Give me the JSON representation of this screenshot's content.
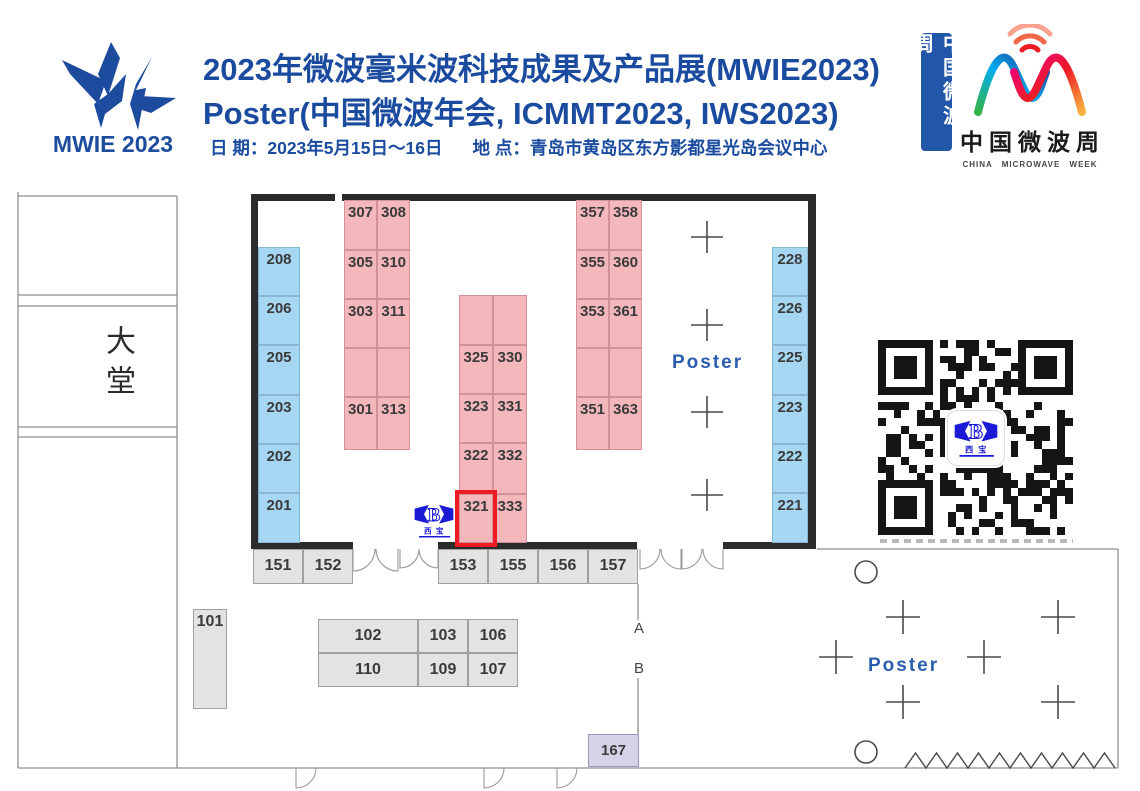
{
  "header": {
    "logo_text": "MWIE 2023",
    "title": "2023年微波毫米波科技成果及产品展(MWIE2023)",
    "subtitle": "Poster(中国微波年会, ICMMT2023, IWS2023)",
    "date_label": "日 期：2023年5月15日～16日",
    "venue_label": "地 点：青岛市黄岛区东方影都星光岛会议中心",
    "badge_vertical": "中国微波周",
    "cmw": {
      "cn": "中国微波周",
      "en": "CHINA MICROWAVE WEEK"
    },
    "brand_blue": "#1b4b9f"
  },
  "floorplan": {
    "lobby_label": "大堂",
    "hall_poster_label": "Poster",
    "outdoor_poster_label": "Poster",
    "entrance_a": "A",
    "entrance_b": "B",
    "highlighted_booth": "321",
    "highlight_color": "#ed1c24",
    "vendor_logo": {
      "letter": "B",
      "name": "西宝",
      "color": "#1b1bd6"
    },
    "booth_colors": {
      "blue": "#a5d6f2",
      "pink": "#f4b7bb",
      "gray": "#e3e3e3",
      "purple": "#d6d2e8"
    },
    "booths": [
      {
        "label": "208",
        "x": 258,
        "y": 247,
        "w": 42,
        "h": 49,
        "t": "blue"
      },
      {
        "label": "206",
        "x": 258,
        "y": 296,
        "w": 42,
        "h": 49,
        "t": "blue"
      },
      {
        "label": "205",
        "x": 258,
        "y": 345,
        "w": 42,
        "h": 50,
        "t": "blue"
      },
      {
        "label": "203",
        "x": 258,
        "y": 395,
        "w": 42,
        "h": 49,
        "t": "blue"
      },
      {
        "label": "202",
        "x": 258,
        "y": 444,
        "w": 42,
        "h": 49,
        "t": "blue"
      },
      {
        "label": "201",
        "x": 258,
        "y": 493,
        "w": 42,
        "h": 50,
        "t": "blue"
      },
      {
        "label": "228",
        "x": 772,
        "y": 247,
        "w": 36,
        "h": 49,
        "t": "blue"
      },
      {
        "label": "226",
        "x": 772,
        "y": 296,
        "w": 36,
        "h": 49,
        "t": "blue"
      },
      {
        "label": "225",
        "x": 772,
        "y": 345,
        "w": 36,
        "h": 50,
        "t": "blue"
      },
      {
        "label": "223",
        "x": 772,
        "y": 395,
        "w": 36,
        "h": 49,
        "t": "blue"
      },
      {
        "label": "222",
        "x": 772,
        "y": 444,
        "w": 36,
        "h": 49,
        "t": "blue"
      },
      {
        "label": "221",
        "x": 772,
        "y": 493,
        "w": 36,
        "h": 50,
        "t": "blue"
      },
      {
        "label": "307",
        "x": 344,
        "y": 200,
        "w": 33,
        "h": 50,
        "t": "pink"
      },
      {
        "label": "308",
        "x": 377,
        "y": 200,
        "w": 33,
        "h": 50,
        "t": "pink"
      },
      {
        "label": "305",
        "x": 344,
        "y": 250,
        "w": 33,
        "h": 49,
        "t": "pink"
      },
      {
        "label": "310",
        "x": 377,
        "y": 250,
        "w": 33,
        "h": 49,
        "t": "pink"
      },
      {
        "label": "303",
        "x": 344,
        "y": 299,
        "w": 33,
        "h": 49,
        "t": "pink"
      },
      {
        "label": "311",
        "x": 377,
        "y": 299,
        "w": 33,
        "h": 49,
        "t": "pink"
      },
      {
        "label": "",
        "x": 344,
        "y": 348,
        "w": 33,
        "h": 49,
        "t": "pink"
      },
      {
        "label": "",
        "x": 377,
        "y": 348,
        "w": 33,
        "h": 49,
        "t": "pink"
      },
      {
        "label": "301",
        "x": 344,
        "y": 397,
        "w": 33,
        "h": 53,
        "t": "pink"
      },
      {
        "label": "313",
        "x": 377,
        "y": 397,
        "w": 33,
        "h": 53,
        "t": "pink"
      },
      {
        "label": "",
        "x": 459,
        "y": 295,
        "w": 34,
        "h": 50,
        "t": "pink"
      },
      {
        "label": "",
        "x": 493,
        "y": 295,
        "w": 34,
        "h": 50,
        "t": "pink"
      },
      {
        "label": "325",
        "x": 459,
        "y": 345,
        "w": 34,
        "h": 49,
        "t": "pink"
      },
      {
        "label": "330",
        "x": 493,
        "y": 345,
        "w": 34,
        "h": 49,
        "t": "pink"
      },
      {
        "label": "323",
        "x": 459,
        "y": 394,
        "w": 34,
        "h": 49,
        "t": "pink"
      },
      {
        "label": "331",
        "x": 493,
        "y": 394,
        "w": 34,
        "h": 49,
        "t": "pink"
      },
      {
        "label": "322",
        "x": 459,
        "y": 443,
        "w": 34,
        "h": 51,
        "t": "pink"
      },
      {
        "label": "332",
        "x": 493,
        "y": 443,
        "w": 34,
        "h": 51,
        "t": "pink"
      },
      {
        "label": "321",
        "x": 459,
        "y": 494,
        "w": 34,
        "h": 49,
        "t": "pink"
      },
      {
        "label": "333",
        "x": 493,
        "y": 494,
        "w": 34,
        "h": 49,
        "t": "pink"
      },
      {
        "label": "357",
        "x": 576,
        "y": 200,
        "w": 33,
        "h": 50,
        "t": "pink"
      },
      {
        "label": "358",
        "x": 609,
        "y": 200,
        "w": 33,
        "h": 50,
        "t": "pink"
      },
      {
        "label": "355",
        "x": 576,
        "y": 250,
        "w": 33,
        "h": 49,
        "t": "pink"
      },
      {
        "label": "360",
        "x": 609,
        "y": 250,
        "w": 33,
        "h": 49,
        "t": "pink"
      },
      {
        "label": "353",
        "x": 576,
        "y": 299,
        "w": 33,
        "h": 49,
        "t": "pink"
      },
      {
        "label": "361",
        "x": 609,
        "y": 299,
        "w": 33,
        "h": 49,
        "t": "pink"
      },
      {
        "label": "",
        "x": 576,
        "y": 348,
        "w": 33,
        "h": 49,
        "t": "pink"
      },
      {
        "label": "",
        "x": 609,
        "y": 348,
        "w": 33,
        "h": 49,
        "t": "pink"
      },
      {
        "label": "351",
        "x": 576,
        "y": 397,
        "w": 33,
        "h": 53,
        "t": "pink"
      },
      {
        "label": "363",
        "x": 609,
        "y": 397,
        "w": 33,
        "h": 53,
        "t": "pink"
      },
      {
        "label": "151",
        "x": 253,
        "y": 549,
        "w": 50,
        "h": 35,
        "t": "gray"
      },
      {
        "label": "152",
        "x": 303,
        "y": 549,
        "w": 50,
        "h": 35,
        "t": "gray"
      },
      {
        "label": "153",
        "x": 438,
        "y": 549,
        "w": 50,
        "h": 35,
        "t": "gray"
      },
      {
        "label": "155",
        "x": 488,
        "y": 549,
        "w": 50,
        "h": 35,
        "t": "gray"
      },
      {
        "label": "156",
        "x": 538,
        "y": 549,
        "w": 50,
        "h": 35,
        "t": "gray"
      },
      {
        "label": "157",
        "x": 588,
        "y": 549,
        "w": 50,
        "h": 35,
        "t": "gray"
      },
      {
        "label": "101",
        "x": 193,
        "y": 609,
        "w": 34,
        "h": 100,
        "t": "gray",
        "va": "top"
      },
      {
        "label": "102",
        "x": 318,
        "y": 619,
        "w": 100,
        "h": 34,
        "t": "gray"
      },
      {
        "label": "103",
        "x": 418,
        "y": 619,
        "w": 50,
        "h": 34,
        "t": "gray"
      },
      {
        "label": "106",
        "x": 468,
        "y": 619,
        "w": 50,
        "h": 34,
        "t": "gray"
      },
      {
        "label": "110",
        "x": 318,
        "y": 653,
        "w": 100,
        "h": 34,
        "t": "gray"
      },
      {
        "label": "109",
        "x": 418,
        "y": 653,
        "w": 50,
        "h": 34,
        "t": "gray"
      },
      {
        "label": "107",
        "x": 468,
        "y": 653,
        "w": 50,
        "h": 34,
        "t": "gray"
      },
      {
        "label": "167",
        "x": 588,
        "y": 734,
        "w": 51,
        "h": 33,
        "t": "purple"
      }
    ]
  }
}
